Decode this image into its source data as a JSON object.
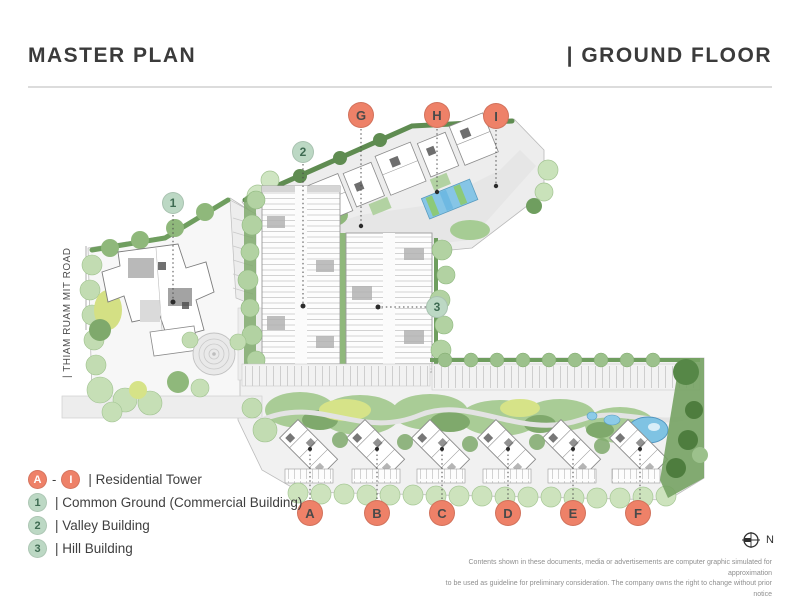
{
  "header": {
    "title_left": "MASTER PLAN",
    "title_right": "| GROUND FLOOR"
  },
  "plan": {
    "road_label": "| THIAM RUAM MIT ROAD",
    "markers": {
      "towers_top": [
        {
          "label": "G"
        },
        {
          "label": "H"
        },
        {
          "label": "I"
        }
      ],
      "towers_bottom": [
        {
          "label": "A"
        },
        {
          "label": "B"
        },
        {
          "label": "C"
        },
        {
          "label": "D"
        },
        {
          "label": "E"
        },
        {
          "label": "F"
        }
      ],
      "facilities": [
        {
          "label": "1"
        },
        {
          "label": "2"
        },
        {
          "label": "3"
        }
      ]
    }
  },
  "legend": {
    "residential": {
      "start_badge": "A",
      "separator": "-",
      "end_badge": "I",
      "label": "| Residential Tower"
    },
    "items": [
      {
        "badge": "1",
        "label": "| Common Ground (Commercial Building)"
      },
      {
        "badge": "2",
        "label": "| Valley Building"
      },
      {
        "badge": "3",
        "label": "| Hill Building"
      }
    ]
  },
  "compass": {
    "label": "N"
  },
  "disclaimer": {
    "line1": "Contents  shown in these documents, media or advertisements are computer graphic simulated for approximation",
    "line2": "to be used as guideline for preliminary consideration. The company owns the right to change without prior notice"
  },
  "colors": {
    "marker-red-bg": "#EE8168",
    "marker-red-text": "#4A4A4A",
    "legend-red-text": "#FFFFFF",
    "marker-green-bg": "#BCD8C4",
    "marker-green-text": "#3E6B52",
    "title-text": "#3B3B3B",
    "divider": "#DCDCDC",
    "disclaimer-text": "#8F8F8F",
    "landscape-green": "#A9CC96",
    "tree-light": "#CDE3BD",
    "hedge-dark": "#6F9E5F",
    "lawn-yellow": "#D6E388",
    "pool-blue": "#7FC3E3",
    "road-gray": "#EDEDED"
  }
}
